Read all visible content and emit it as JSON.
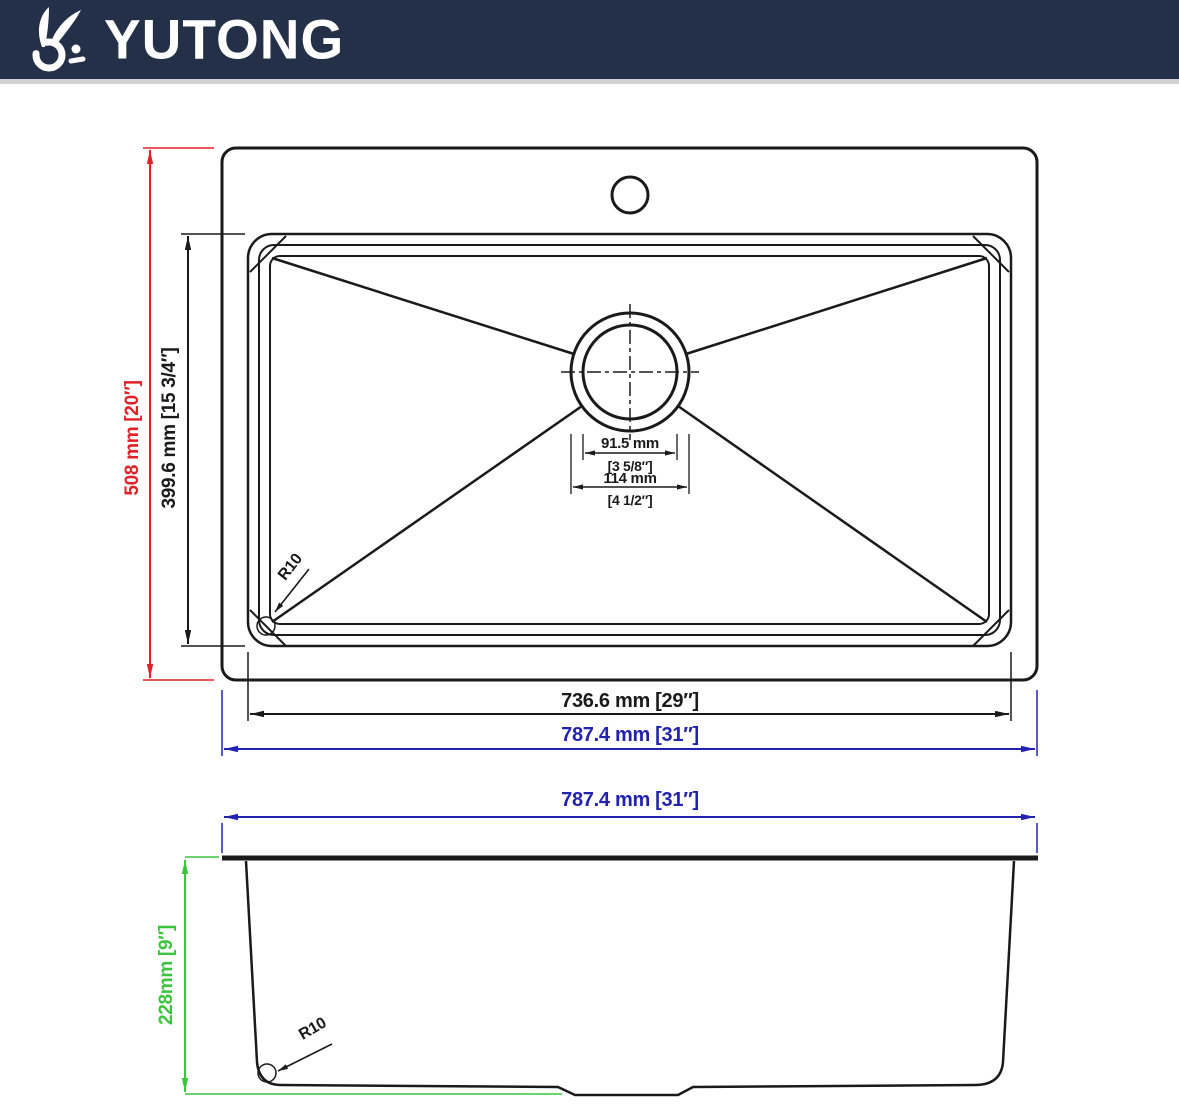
{
  "header": {
    "brand": "YUTONG",
    "logo_icon": "rabbit-logo"
  },
  "colors": {
    "header_bg": "#243047",
    "dimension_red": "#e02228",
    "dimension_blue": "#2222b0",
    "dimension_green": "#3dc43d",
    "drawing_black": "#1a1a1a"
  },
  "top_view": {
    "overall_height_label": "508 mm [20″]",
    "bowl_height_label": "399.6 mm [15 3/4″]",
    "bowl_width_label": "736.6 mm [29″]",
    "overall_width_label": "787.4 mm [31″]",
    "drain_inner_diameter_label": "91.5 mm",
    "drain_inner_diameter_inches_label": "[3 5/8″]",
    "drain_outer_diameter_label": "114 mm",
    "drain_outer_diameter_inches_label": "[4 1/2″]",
    "corner_radius_label": "R10"
  },
  "side_view": {
    "overall_width_label": "787.4 mm [31″]",
    "depth_label": "228mm [9″]",
    "corner_radius_label": "R10"
  }
}
